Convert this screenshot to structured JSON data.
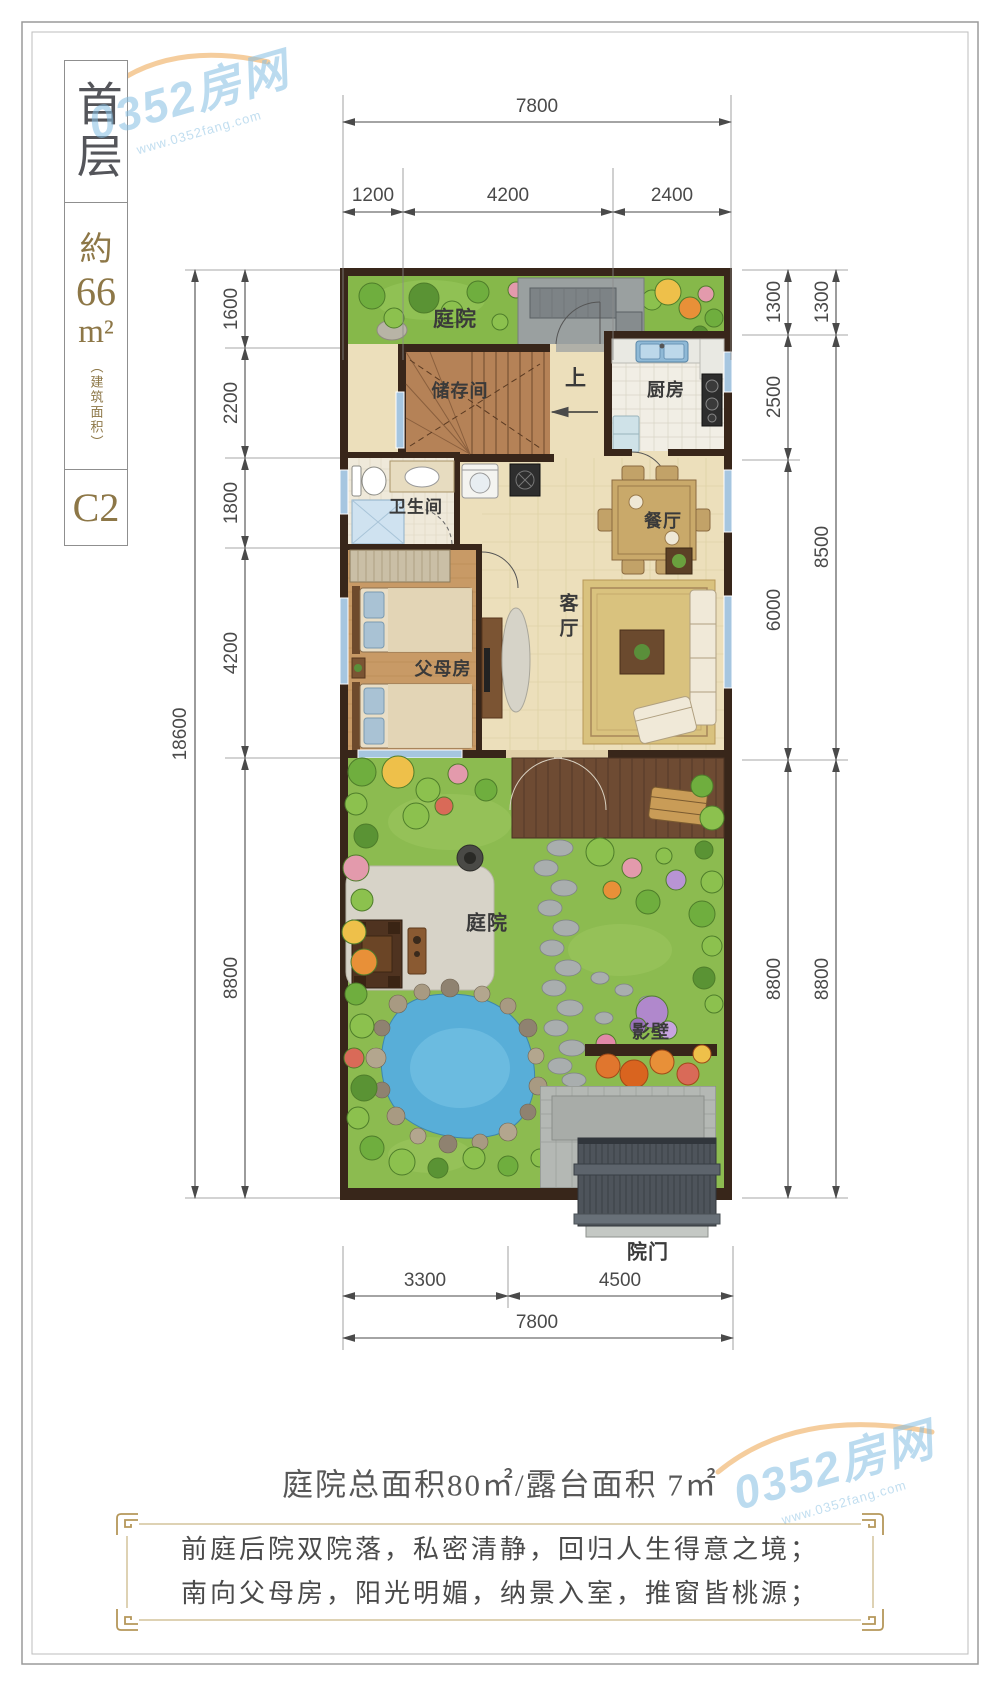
{
  "watermark": {
    "brand": "0352房网",
    "url": "www.0352fang.com"
  },
  "sidebar": {
    "floor_label": "首层",
    "approx_prefix": "約",
    "area_value": "66",
    "area_unit": "m²",
    "area_note": "（建筑面积）",
    "unit_code": "C2"
  },
  "rooms": {
    "front_yard": "庭院",
    "storage": "储存间",
    "up": "上",
    "kitchen": "厨房",
    "bath": "卫生间",
    "dining": "餐厅",
    "living": "客厅",
    "parents": "父母房",
    "rear_yard": "庭院",
    "screen_wall": "影壁",
    "gate": "院门"
  },
  "dims": {
    "top_total": "7800",
    "top_segments": [
      "1200",
      "4200",
      "2400"
    ],
    "left_total": "18600",
    "left_segments": [
      "1600",
      "2200",
      "1800",
      "4200",
      "8800"
    ],
    "right_inner": [
      "1300",
      "2500",
      "6000",
      "8800"
    ],
    "right_outer": [
      "1300",
      "8500",
      "8800"
    ],
    "bottom_segments": [
      "3300",
      "4500"
    ],
    "bottom_total": "7800"
  },
  "summary": "庭院总面积80㎡/露台面积 7㎡",
  "description_lines": [
    "前庭后院双院落，私密清静，回归人生得意之境；",
    "南向父母房，阳光明媚，纳景入室，推窗皆桃源；"
  ]
}
